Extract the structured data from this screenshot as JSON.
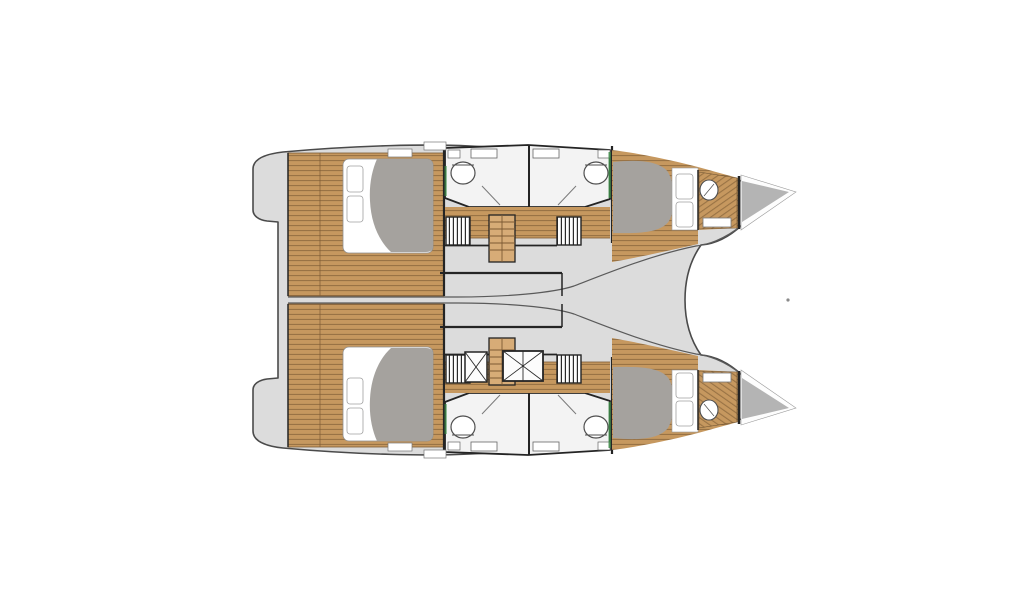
{
  "figure": {
    "kind": "boat-deck-plan",
    "subject": "catamaran-4-cabin-interior-layout",
    "view": "top-down"
  },
  "colors": {
    "page_background": "#ffffff",
    "deck": "#dcdcdc",
    "hull_outline": "#4a4a4a",
    "wall": "#242424",
    "inner_line": "#5a5a5a",
    "wood": "#c6985f",
    "wood_line": "#7c5a33",
    "wood_light": "#d7ac77",
    "mattress": "#ffffff",
    "duvet": "#a5a29e",
    "bow_locker": "#b4b4b4",
    "bathroom_floor": "#f3f3f3",
    "fixture": "#4f4f4f",
    "pillow_edge": "#a0a0a0",
    "accent_green": "#3c8a46",
    "hatch_line": "#2a2a2a",
    "dot": "#8a8a8a"
  },
  "vessel": {
    "hulls": [
      {
        "name": "port-hull",
        "features": [
          "aft-double-berth-cabin",
          "aft-head-with-toilet",
          "forward-head-with-toilet",
          "companionway-stairs",
          "wardrobe-louvers",
          "forward-double-berth-cabin",
          "bow-washbasin",
          "forepeak-locker"
        ]
      },
      {
        "name": "starboard-hull",
        "features": [
          "aft-double-berth-cabin",
          "aft-head-with-toilet",
          "forward-head-with-toilet",
          "companionway-stairs",
          "wardrobe-louvers",
          "forward-double-berth-cabin",
          "bow-washbasin",
          "forepeak-locker",
          "deck-hatch-small",
          "deck-hatch-large"
        ]
      }
    ],
    "center": [
      "bridge-deck",
      "bow-trampoline-opening",
      "stern-platform-steps"
    ]
  }
}
